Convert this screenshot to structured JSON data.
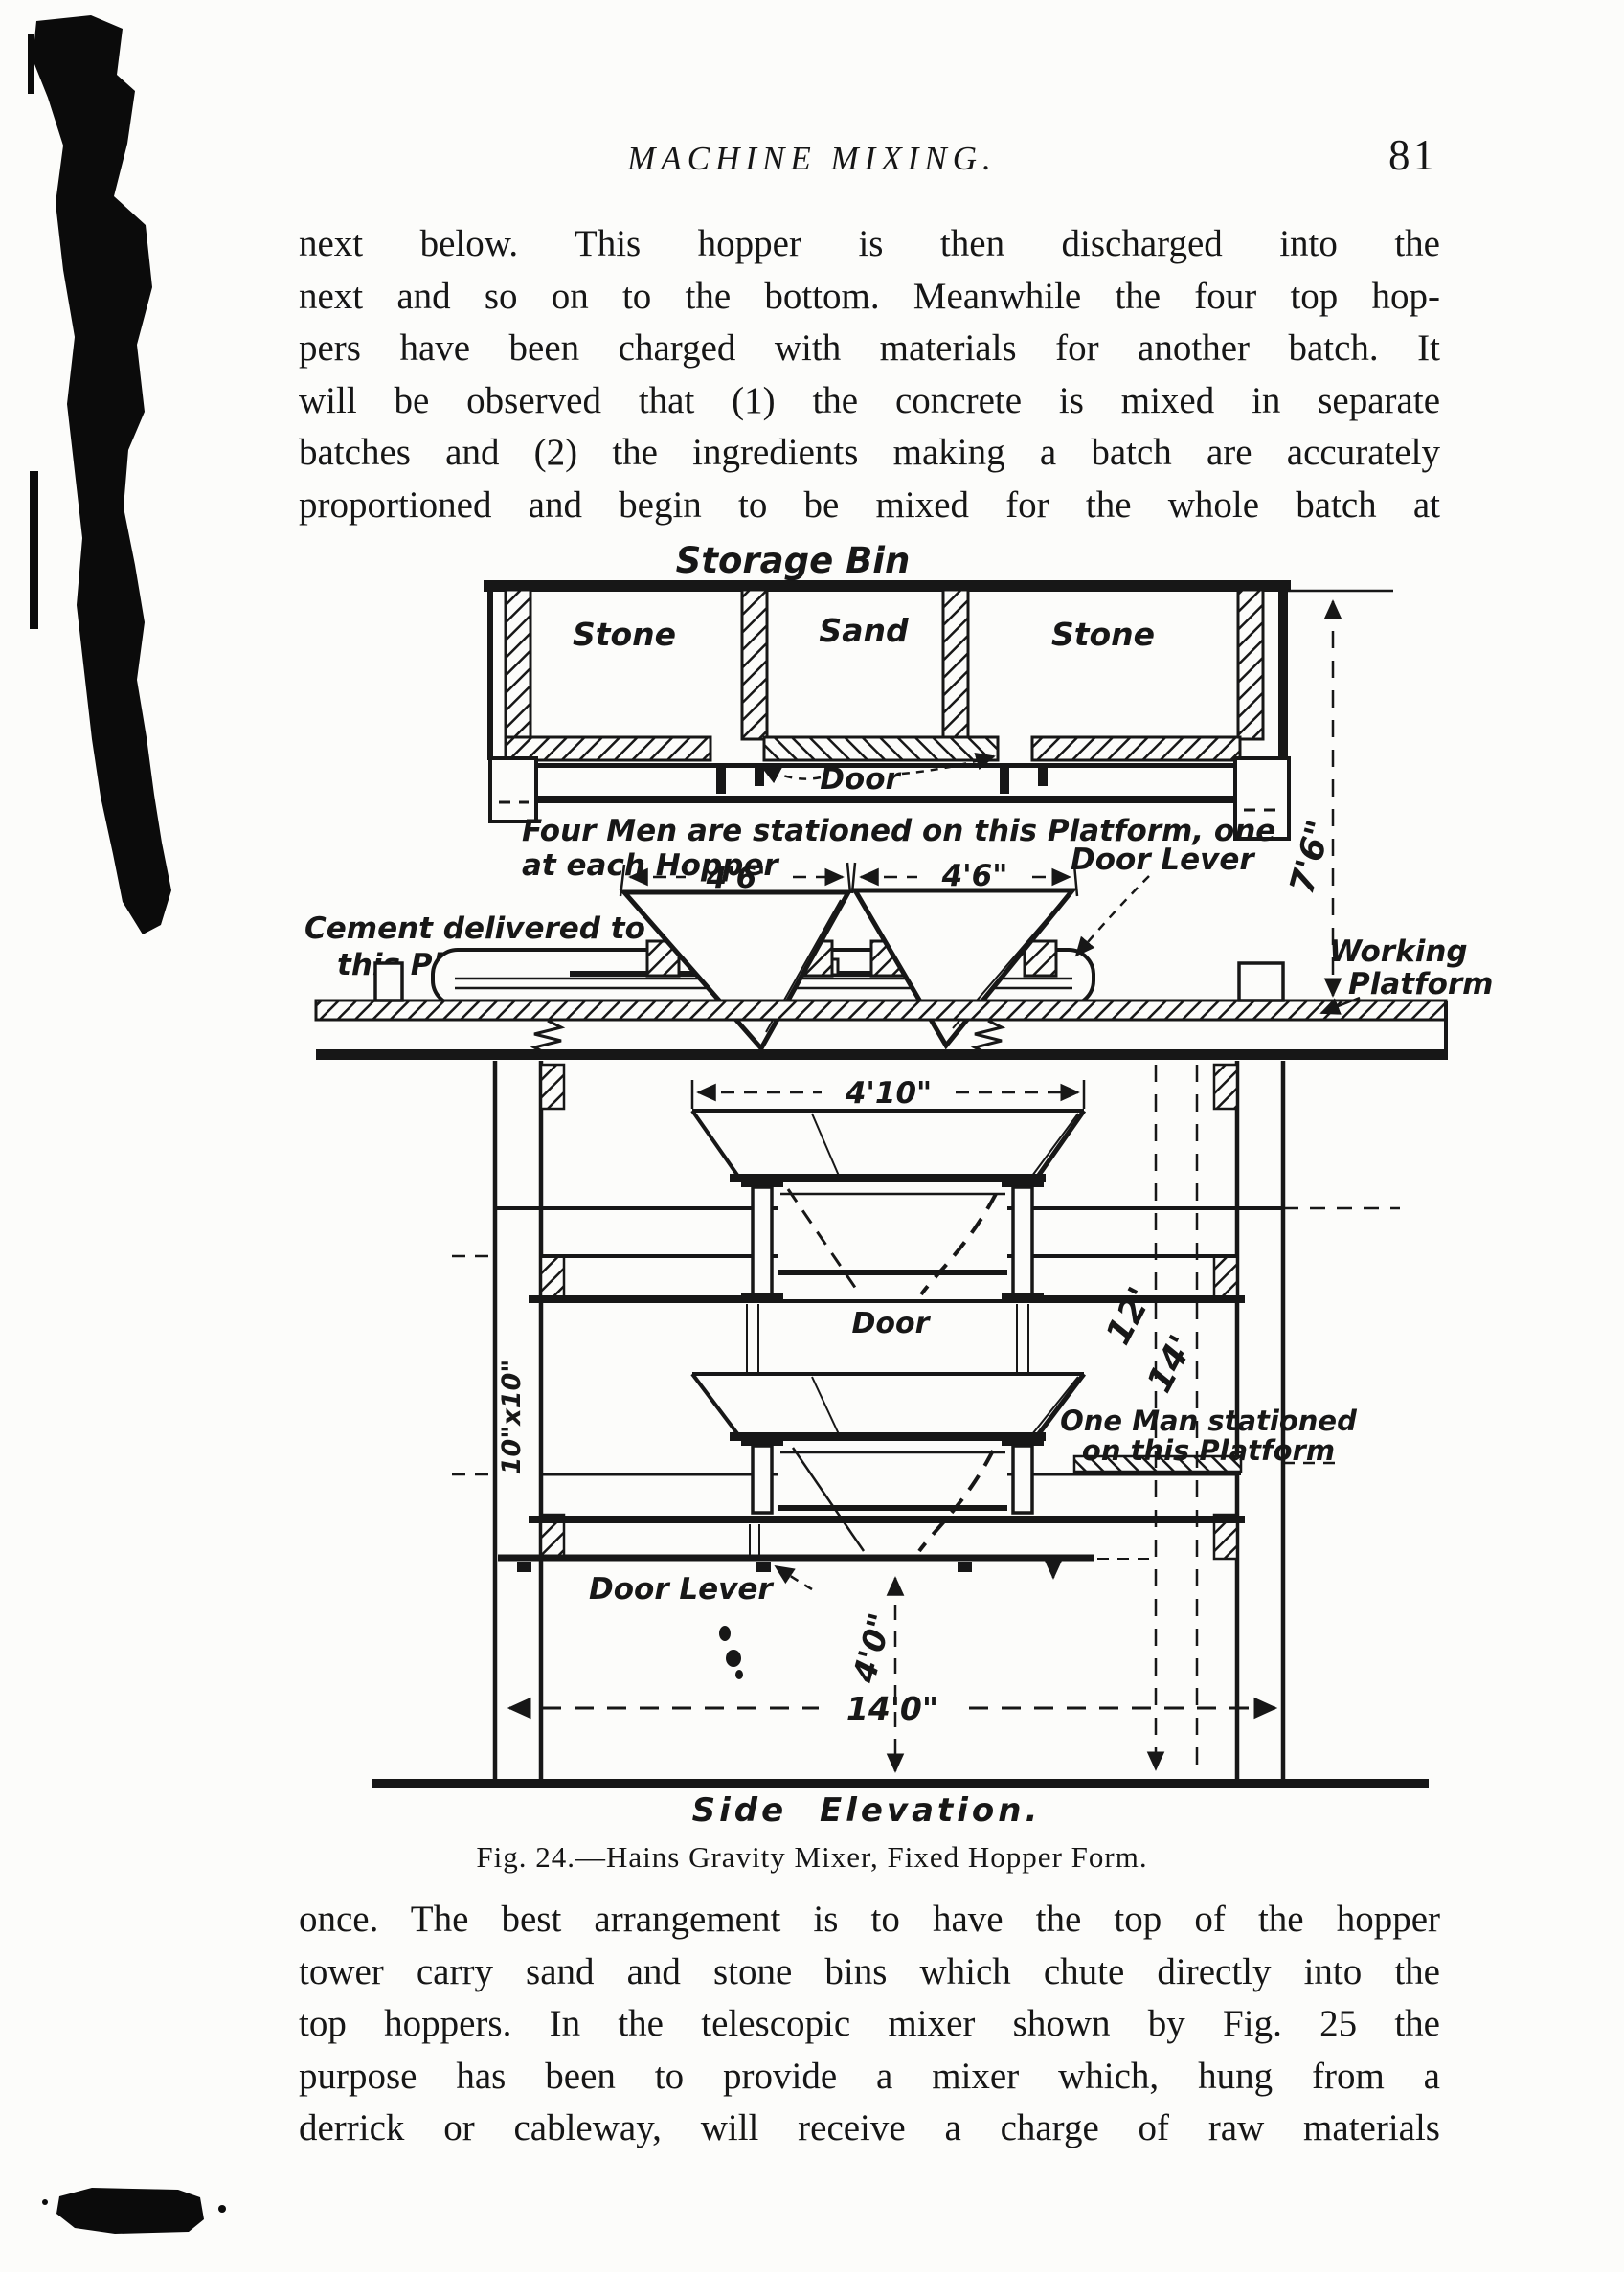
{
  "header": {
    "title": "MACHINE MIXING.",
    "page_number": "81"
  },
  "paragraph_top": {
    "lines": [
      "next below.  This hopper is then discharged into the",
      "next and so on to the bottom.  Meanwhile the four top hop-",
      "pers have been charged with materials for another batch.  It",
      "will be observed that (1) the concrete is mixed in separate",
      "batches and (2) the ingredients making a batch are accurately",
      "proportioned and begin to be mixed for the whole batch at"
    ]
  },
  "figure": {
    "caption": "Fig. 24.—Hains Gravity Mixer, Fixed Hopper Form.",
    "labels": {
      "storage_bin": "Storage Bin",
      "bin_left": "Stone",
      "bin_mid": "Sand",
      "bin_right": "Stone",
      "bin_door": "Door",
      "four_men_line1": "Four Men are stationed on this Platform, one",
      "four_men_line2": "at each Hopper",
      "dim_46_left": "4'6\"",
      "dim_46_right": "4'6\"",
      "cement_line1": "Cement delivered to",
      "cement_line2": "this Platform",
      "door_lever_top": "Door Lever",
      "working_line1": "Working",
      "working_line2": "Platform",
      "dim_76": "7'6\"",
      "dim_410": "4'10\"",
      "post_size": "10\"x10\"",
      "door_mid": "Door",
      "dim_12": "12'",
      "dim_14": "14'",
      "one_man_line1": "One Man stationed",
      "one_man_line2": "on this Platform",
      "door_lever_bottom": "Door Lever",
      "dim_40": "4'0\"",
      "dim_140": "14'0\"",
      "view_label": "Side  Elevation."
    }
  },
  "paragraph_bottom": {
    "lines": [
      "once.  The best arrangement is to have the top of the hopper",
      "tower carry sand and stone bins which chute directly into the",
      "top hoppers.  In the telescopic mixer shown by Fig. 25 the",
      "purpose has been to provide a mixer which, hung from a",
      "derrick or cableway, will receive a charge of raw materials"
    ]
  },
  "colors": {
    "paper": "#fcfcfa",
    "ink": "#171717"
  }
}
